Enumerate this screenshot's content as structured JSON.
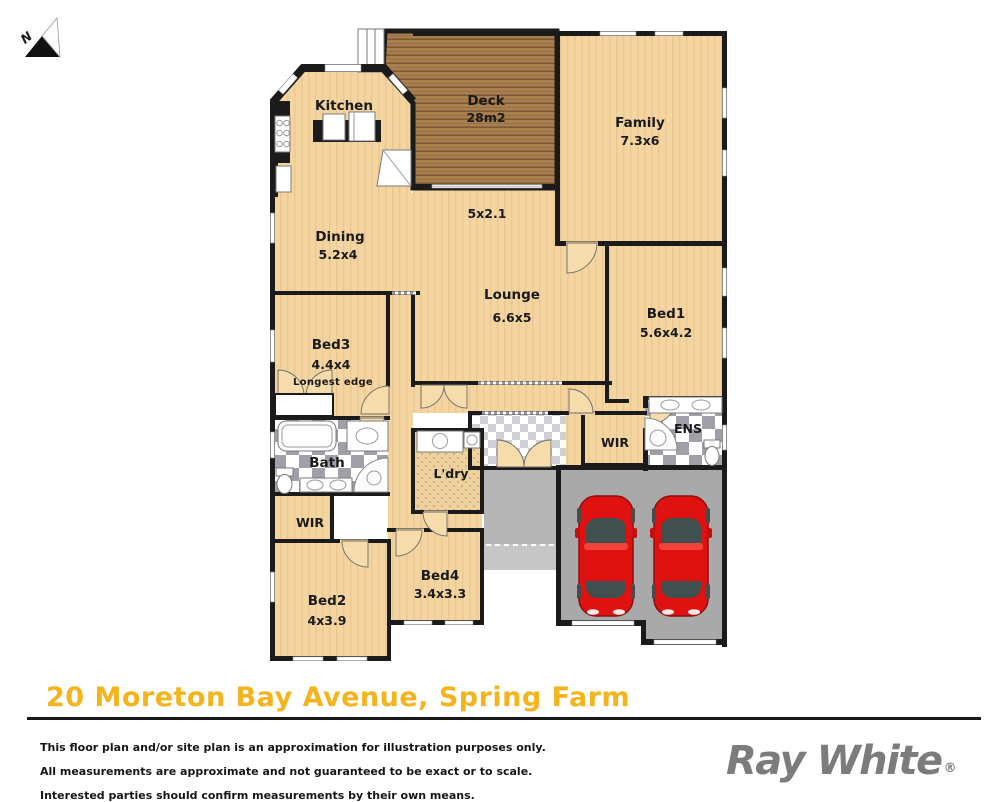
{
  "compass": {
    "label": "N"
  },
  "plan": {
    "rooms": {
      "kitchen": {
        "name": "Kitchen"
      },
      "deck": {
        "name": "Deck",
        "dim": "28m2"
      },
      "family": {
        "name": "Family",
        "dim": "7.3x6"
      },
      "hall": {
        "dim": "5x2.1"
      },
      "dining": {
        "name": "Dining",
        "dim": "5.2x4"
      },
      "lounge": {
        "name": "Lounge",
        "dim": "6.6x5"
      },
      "bed1": {
        "name": "Bed1",
        "dim": "5.6x4.2"
      },
      "bed3": {
        "name": "Bed3",
        "dim": "4.4x4",
        "note": "Longest edge"
      },
      "bath": {
        "name": "Bath"
      },
      "ldry": {
        "name": "L'dry"
      },
      "wir_left": {
        "name": "WIR"
      },
      "wir_right": {
        "name": "WIR"
      },
      "ens": {
        "name": "ENS"
      },
      "bed2": {
        "name": "Bed2",
        "dim": "4x3.9"
      },
      "bed4": {
        "name": "Bed4",
        "dim": "3.4x3.3"
      }
    },
    "colors": {
      "floor": "#f4d5a1",
      "wall": "#1b1b1b",
      "deck": "#a97e51",
      "garage": "#a9a9a9",
      "porch": "#b4b4b4",
      "tile_gray": "#9fa0a8",
      "car": "#e01111",
      "accent": "#f5b41d",
      "brand_gray": "#7c7c7c"
    }
  },
  "footer": {
    "address": "20 Moreton Bay Avenue, Spring Farm",
    "disclaimer": [
      "This floor plan and/or site plan is an approximation for illustration purposes only.",
      "All measurements are approximate and not guaranteed to be exact or to scale.",
      "Interested parties should confirm measurements by their own means."
    ],
    "brand": "Ray White",
    "brand_mark": "®"
  }
}
